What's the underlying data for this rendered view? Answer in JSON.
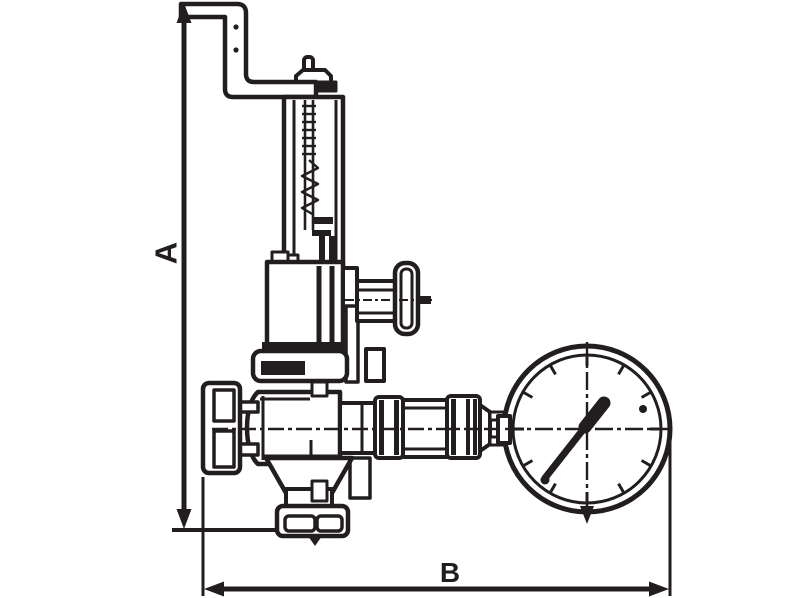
{
  "page": {
    "background": "#ffffff",
    "ink": "#221e1f",
    "description": "dimensional line drawing of a spring safety/reducing valve with test lever and pressure gauge"
  },
  "dimensions": {
    "a_label": "A",
    "b_label": "B"
  },
  "components": [
    "lift-lever",
    "cap-pin",
    "adjusting-cap",
    "spring-housing",
    "bonnet",
    "side-stem",
    "side-handle",
    "body-band",
    "valve-body",
    "inlet-flange",
    "inlet-pipe",
    "outlet-cone",
    "outlet-flange",
    "gauge-union",
    "connection-pipe",
    "pressure-gauge",
    "gauge-needle"
  ]
}
